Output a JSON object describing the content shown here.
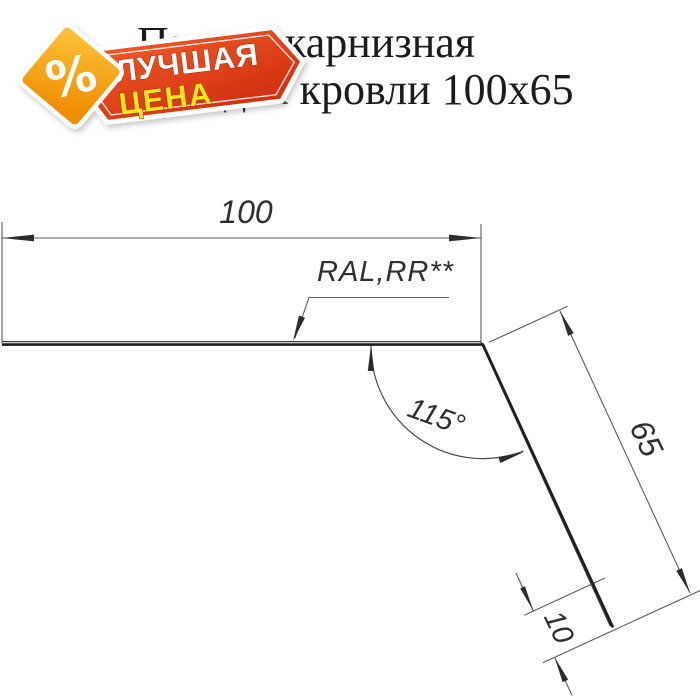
{
  "page": {
    "background": "#ffffff"
  },
  "title": {
    "line1": "Планка карнизная",
    "line2": "для кровли 100х65"
  },
  "badge": {
    "percent_symbol": "%",
    "word1": "ЛУЧШАЯ",
    "word2": "ЦЕНА",
    "colors": {
      "ribbon_dark": "#d23110",
      "ribbon_light": "#f05a28",
      "diamond_dark": "#f08c00",
      "diamond_light": "#fcc63d",
      "word1_text": "#ffffff",
      "word2_text": "#ffe71c",
      "border": "#ffffff"
    }
  },
  "drawing": {
    "dim_width": "100",
    "dim_slope": "65",
    "dim_hem": "10",
    "angle": "115°",
    "coating_label": "RAL,RR**",
    "line_color": "#1e1e1e",
    "dim_color": "#5a5a5a"
  }
}
